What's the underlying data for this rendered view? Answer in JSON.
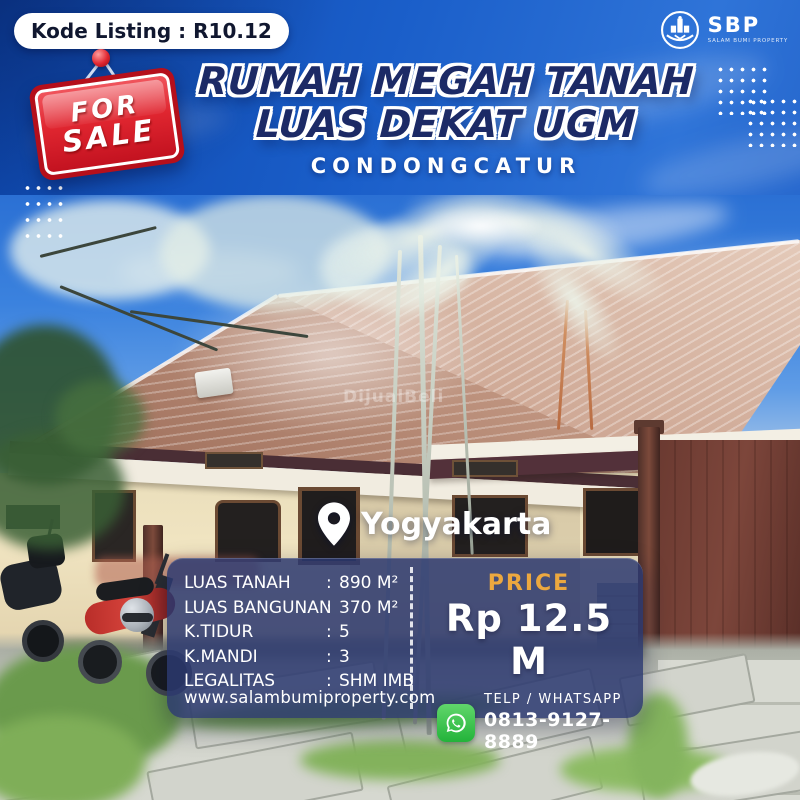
{
  "listing": {
    "code_label": "Kode Listing : R10.12"
  },
  "sale_sign": {
    "line1": "FOR",
    "line2": "SALE"
  },
  "header": {
    "title_line1": "RUMAH MEGAH TANAH",
    "title_line2": "LUAS DEKAT UGM",
    "subtitle": "CONDONGCATUR"
  },
  "logo": {
    "abbr": "SBP",
    "tagline": "SALAM BUMI PROPERTY"
  },
  "photo": {
    "location": "Yogyakarta",
    "watermark": "DijualBeli"
  },
  "specs": {
    "rows": [
      {
        "label": "LUAS TANAH",
        "sep": ":",
        "value": "890 M²"
      },
      {
        "label": "LUAS BANGUNAN",
        "sep": ":",
        "value": "370 M²"
      },
      {
        "label": "K.TIDUR",
        "sep": ":",
        "value": "5"
      },
      {
        "label": "K.MANDI",
        "sep": ":",
        "value": "3"
      },
      {
        "label": "LEGALITAS",
        "sep": ":",
        "value": "SHM IMB"
      }
    ],
    "website": "www.salambumiproperty.com"
  },
  "price": {
    "label": "PRICE",
    "value": "Rp 12.5 M"
  },
  "contact": {
    "label": "TELP / WHATSAPP",
    "phone": "0813-9127-8889"
  },
  "colors": {
    "background_blue": "#1a5ec9",
    "title_navy": "#1c2a66",
    "sign_red": "#D8232A",
    "panel_navy": "#2c3870",
    "price_gold": "#ECA83F",
    "whatsapp_green": "#25B33C",
    "text_white": "#FFFFFF"
  }
}
